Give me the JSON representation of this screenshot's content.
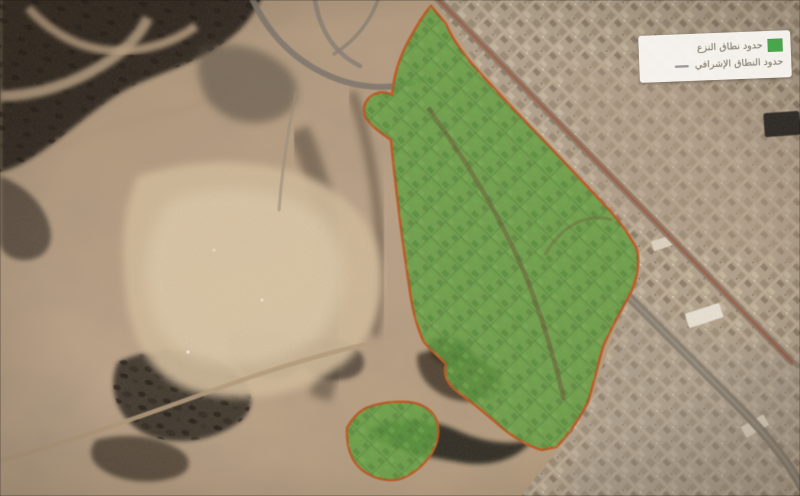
{
  "legend": {
    "items": [
      {
        "id": "expropriation-zone",
        "label": "حدود نطاق النزع",
        "symbol": "area-swatch",
        "color": "#4aa64a"
      },
      {
        "id": "supervisory-zone",
        "label": "حدود النطاق الإشرافي",
        "symbol": "line-swatch",
        "color": "#9a9a9a"
      }
    ]
  },
  "map": {
    "type": "satellite",
    "overlay": {
      "expropriation_area_fill": "#5fa23d",
      "expropriation_area_border": "#c2571f"
    }
  }
}
